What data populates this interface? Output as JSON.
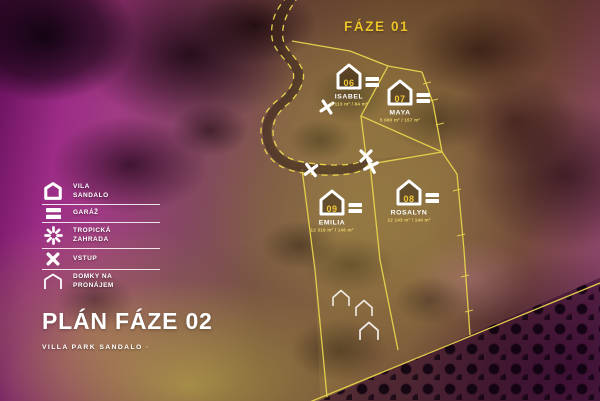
{
  "map": {
    "phase01_label": "FÁZE 01",
    "plots": [
      {
        "number": "06",
        "name": "ISABEL",
        "area": "5 113 m² / 84 m²"
      },
      {
        "number": "07",
        "name": "MAYA",
        "area": "5 080 m² / 157 m²"
      },
      {
        "number": "09",
        "name": "EMILIA",
        "area": "12 319 m² / 146 m²"
      },
      {
        "number": "08",
        "name": "ROSALYN",
        "area": "12 143 m² / 144 m²"
      }
    ]
  },
  "legend": {
    "items": [
      {
        "icon": "villa-icon",
        "label": "VILA SANDALO"
      },
      {
        "icon": "garage-icon",
        "label": "GARÁŽ"
      },
      {
        "icon": "tropical-garden-icon",
        "label": "TROPICKÁ ZAHRADA"
      },
      {
        "icon": "entrance-icon",
        "label": "VSTUP"
      },
      {
        "icon": "rental-homes-icon",
        "label": "DOMKY NA PRONÁJEM"
      }
    ]
  },
  "title_block": {
    "title": "PLÁN FÁZE 02",
    "subtitle": "VILLA PARK SANDALO ·"
  },
  "colors": {
    "accent_yellow": "#ecc428",
    "boundary_yellow": "#e8d44d",
    "white": "#ffffff"
  }
}
